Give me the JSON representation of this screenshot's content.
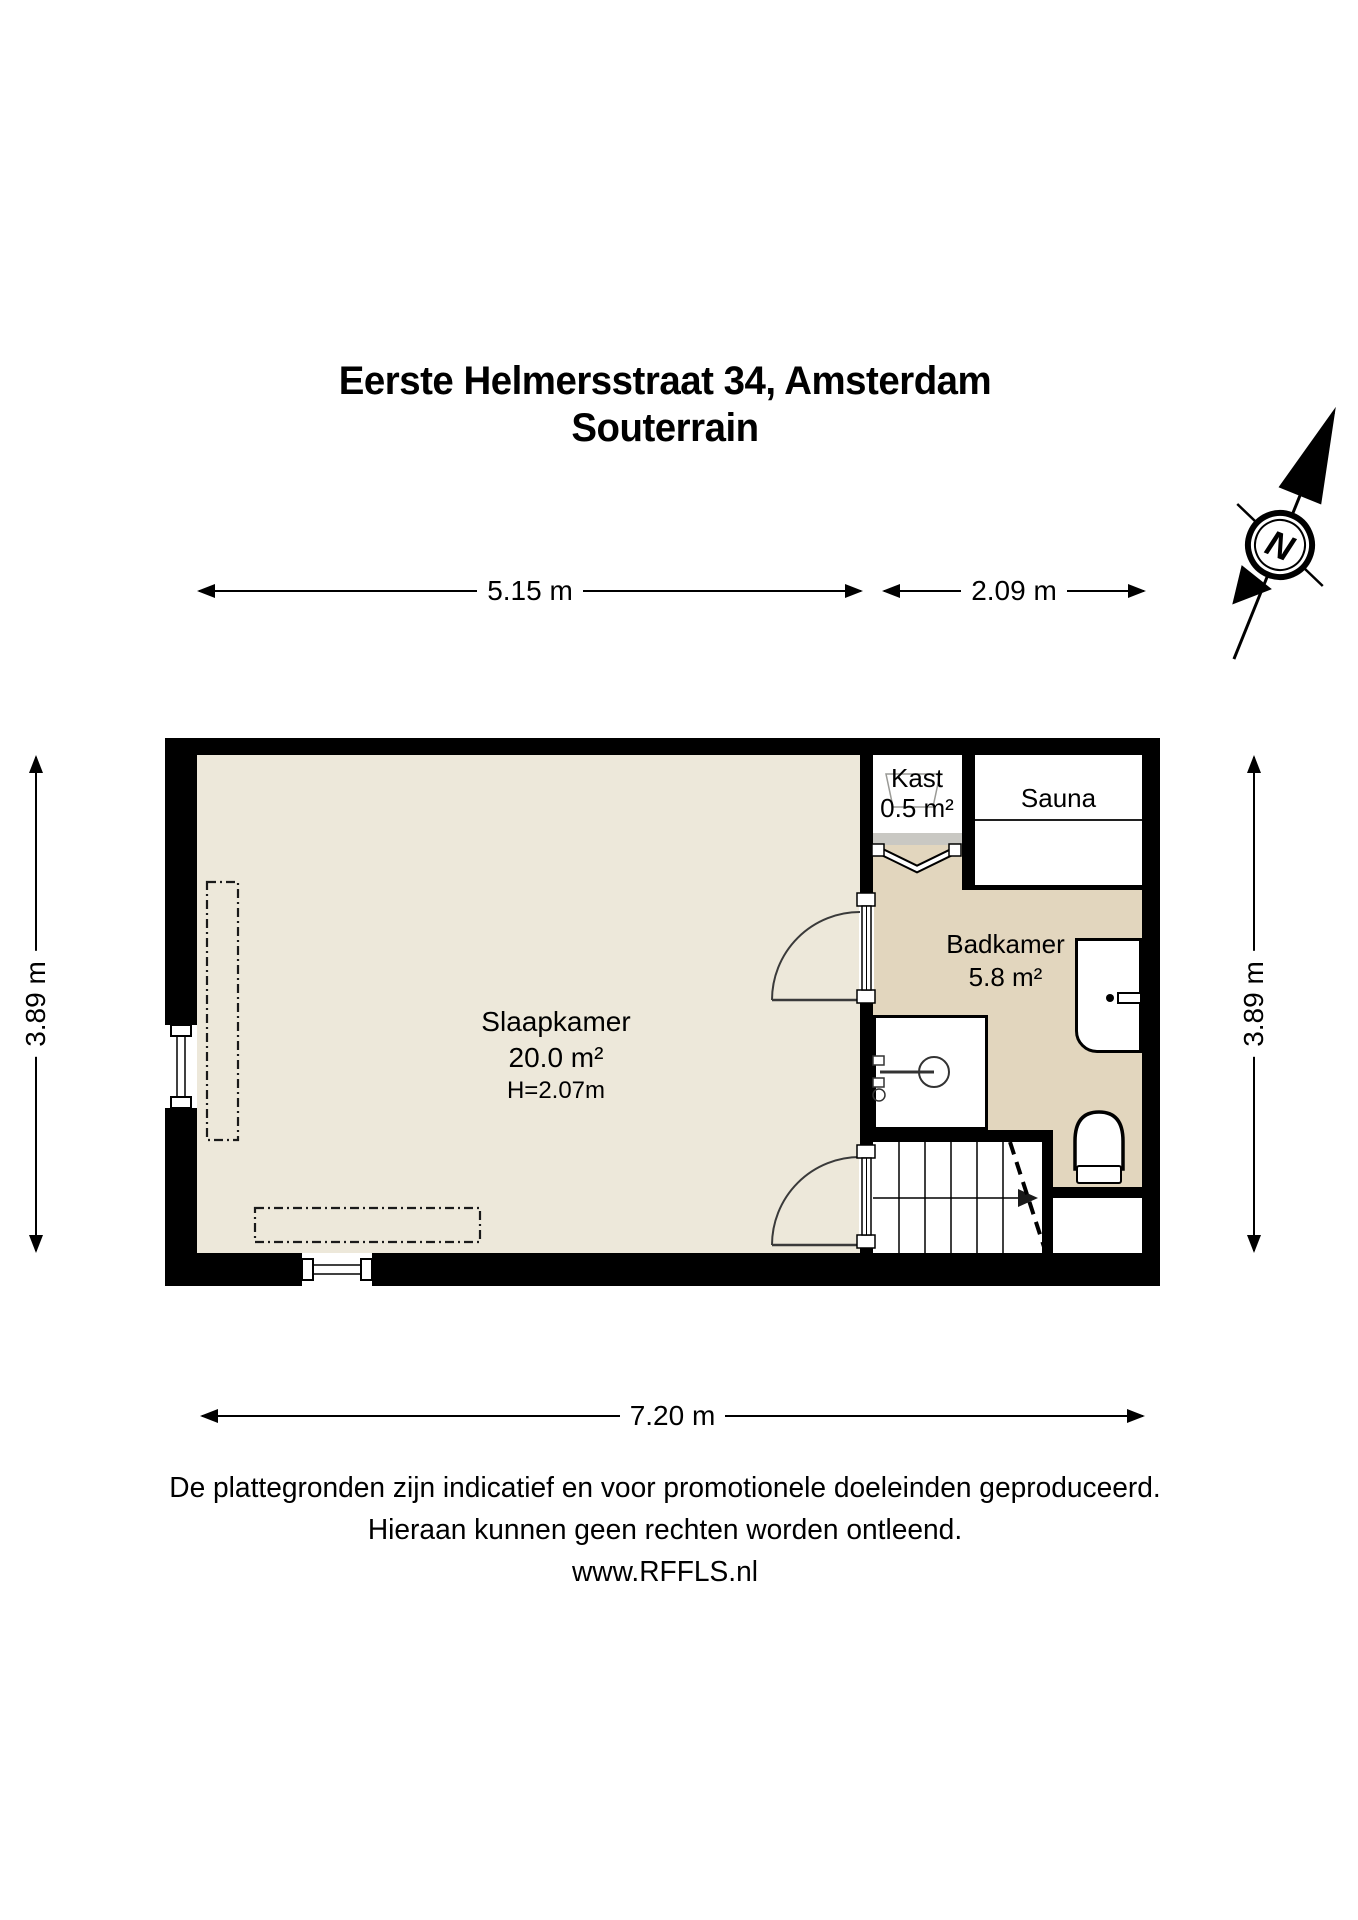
{
  "title": {
    "line1": "Eerste Helmersstraat 34, Amsterdam",
    "line2": "Souterrain"
  },
  "compass": {
    "label": "N"
  },
  "dimensions": {
    "top_left": "5.15 m",
    "top_right": "2.09 m",
    "left": "3.89 m",
    "right": "3.89 m",
    "bottom": "7.20 m"
  },
  "rooms": {
    "slaapkamer": {
      "name": "Slaapkamer",
      "area": "20.0 m²",
      "height": "H=2.07m"
    },
    "kast": {
      "name": "Kast",
      "area": "0.5 m²"
    },
    "sauna": {
      "name": "Sauna"
    },
    "badkamer": {
      "name": "Badkamer",
      "area": "5.8 m²"
    }
  },
  "footer": {
    "line1": "De plattegronden zijn indicatief en voor promotionele doeleinden geproduceerd.",
    "line2": "Hieraan kunnen geen rechten worden ontleend.",
    "line3": "www.RFFLS.nl"
  },
  "colors": {
    "wall": "#000000",
    "floor_main": "#EDE8DA",
    "floor_bath": "#E2D6BE",
    "threshold": "#C9C8C3"
  }
}
